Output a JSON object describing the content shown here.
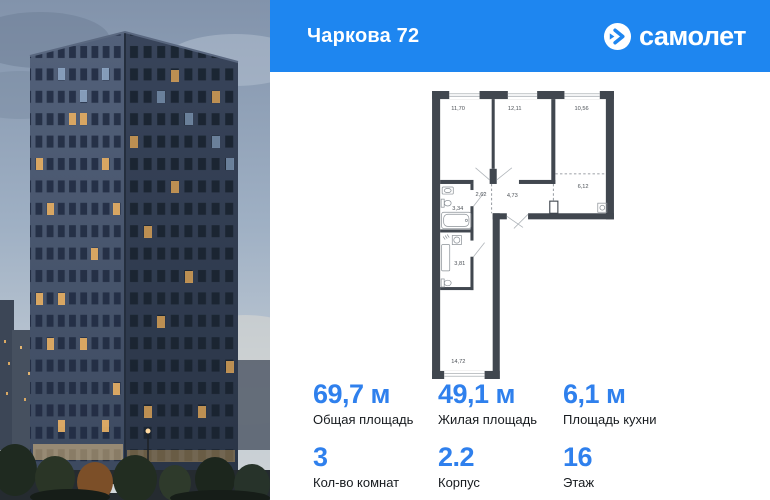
{
  "header": {
    "project_title": "Чаркова 72",
    "brand": "самолет",
    "brand_color": "#1e86f0"
  },
  "floorplan": {
    "rooms": [
      {
        "name": "bedroom-1",
        "area": "11,70"
      },
      {
        "name": "bedroom-2",
        "area": "12,11"
      },
      {
        "name": "bedroom-3",
        "area": "10,56"
      },
      {
        "name": "hall",
        "area": "2,62"
      },
      {
        "name": "corridor",
        "area": "4,73"
      },
      {
        "name": "bathroom-1",
        "area": "3,34"
      },
      {
        "name": "kitchen-zone",
        "area": "6,12"
      },
      {
        "name": "bathroom-2",
        "area": "3,81"
      },
      {
        "name": "living-room",
        "area": "14,72"
      }
    ]
  },
  "stats": {
    "accent_color": "#2f80ed",
    "primary": [
      {
        "value": "69,7 м",
        "label": "Общая площадь"
      },
      {
        "value": "49,1 м",
        "label": "Жилая площадь"
      },
      {
        "value": "6,1 м",
        "label": "Площадь кухни"
      }
    ],
    "secondary": [
      {
        "value": "3",
        "label": "Кол-во комнат"
      },
      {
        "value": "2.2",
        "label": "Корпус"
      },
      {
        "value": "16",
        "label": "Этаж"
      }
    ]
  },
  "icons": {
    "logo_icon": "samolet-arrow-in-circle"
  }
}
